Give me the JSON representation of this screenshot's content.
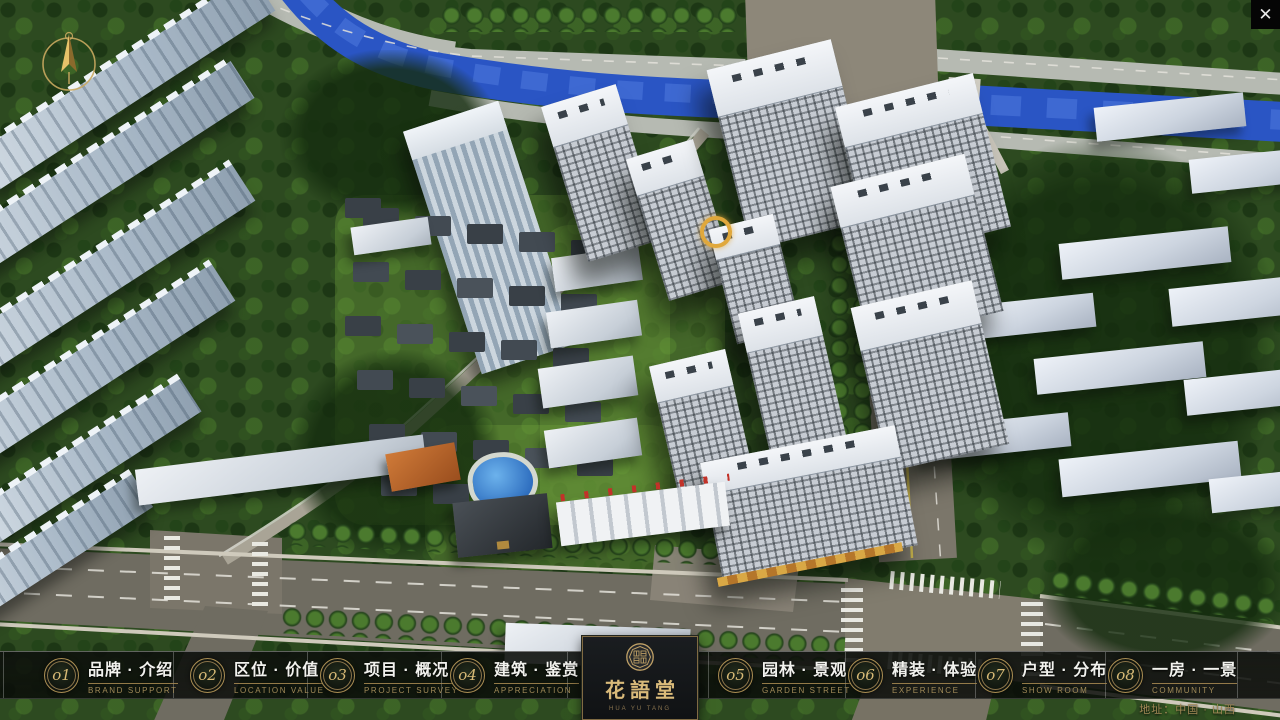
{
  "window": {
    "close_icon": "✕"
  },
  "nav": {
    "items": [
      {
        "num": "o1",
        "label": "品牌 · 介绍",
        "sub": "BRAND SUPPORT"
      },
      {
        "num": "o2",
        "label": "区位 · 价值",
        "sub": "LOCATION VALUE"
      },
      {
        "num": "o3",
        "label": "项目 · 概况",
        "sub": "PROJECT SURVEY"
      },
      {
        "num": "o4",
        "label": "建筑 · 鉴赏",
        "sub": "APPRECIATION"
      },
      {
        "num": "o5",
        "label": "园林 · 景观",
        "sub": "GARDEN STREET"
      },
      {
        "num": "o6",
        "label": "精装 · 体验",
        "sub": "EXPERIENCE"
      },
      {
        "num": "o7",
        "label": "户型 · 分布",
        "sub": "SHOW ROOM"
      },
      {
        "num": "o8",
        "label": "一房 · 一景",
        "sub": "COMMUNITY"
      }
    ]
  },
  "logo": {
    "title": "花語堂",
    "subtitle": "HUA YU TANG"
  },
  "footer": {
    "address": "地址：中国 · 山西"
  },
  "colors": {
    "gold": "#bfa066",
    "navbar_bg": "#0d100c",
    "river": "#2a55c4",
    "road": "#6f6c61"
  }
}
